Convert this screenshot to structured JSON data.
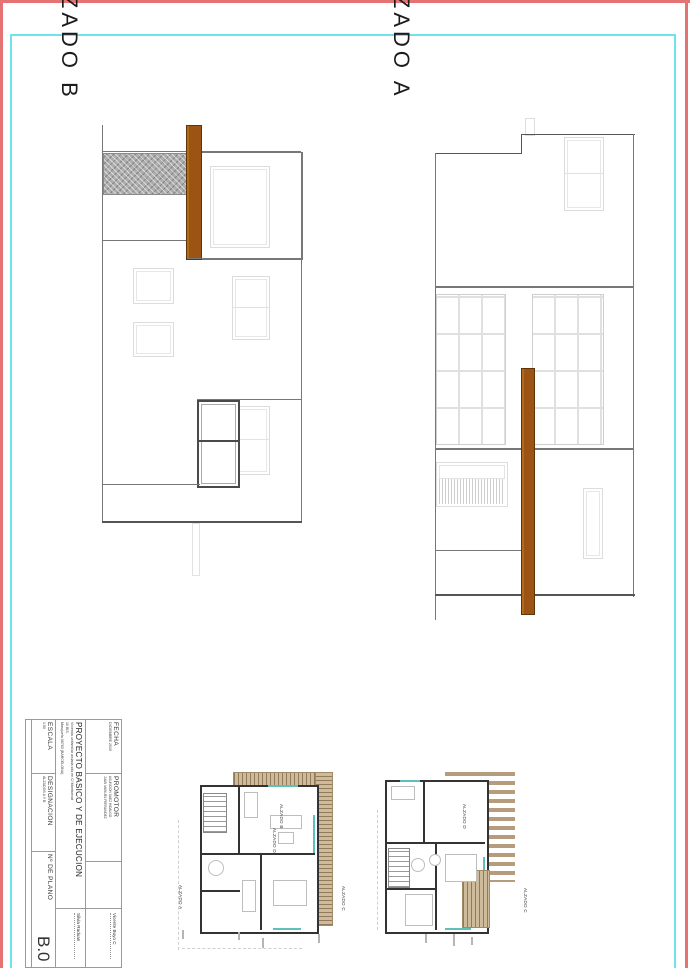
{
  "sheet": {
    "border_color": "#e57373",
    "frame_color": "#6fe3ec",
    "wood_color": "#9c5414",
    "gravel_color": "#adadad",
    "deck_color": "#cdbb9b",
    "glazing_color": "#5ec0ba"
  },
  "titles": {
    "elev_b": "ALZADO B",
    "elev_a": "ALZADO A"
  },
  "title_block": {
    "fecha": {
      "label": "FECHA",
      "value": "DICIEMBRE 2019"
    },
    "promotor": {
      "label": "PROMOTOR",
      "name1": "ASUNCION SAEZ HIDALGO",
      "name2": "JUAN MANUEL FERNANDEZ"
    },
    "proyecto": {
      "title": "PROYECTO BASICO Y DE EJECUCION",
      "line1": "Vivienda unifamiliar aislada sita en C/ Montserrat",
      "line2": "10 BIS,",
      "line3": "Masquefa 08783 (BARCELONA)"
    },
    "escala": {
      "label": "ESCALA",
      "value": "1:50"
    },
    "designacion": {
      "label": "DESIGNACION",
      "value": "ALZADOS A Y B"
    },
    "num_plano": {
      "label": "Nº DE PLANO",
      "value": "B.0"
    },
    "architects": [
      {
        "name": "Silvia Raduan"
      },
      {
        "name": "Vicente Buyo C"
      }
    ]
  },
  "plans": {
    "plan1": {
      "label_left": "ALZADO A",
      "label_top": "ALZADO B",
      "label_mid": "ALZADO D",
      "label_right": "ALZADO C"
    },
    "plan2": {
      "label_top": "ALZADO D",
      "label_right": "ALZADO C"
    }
  }
}
